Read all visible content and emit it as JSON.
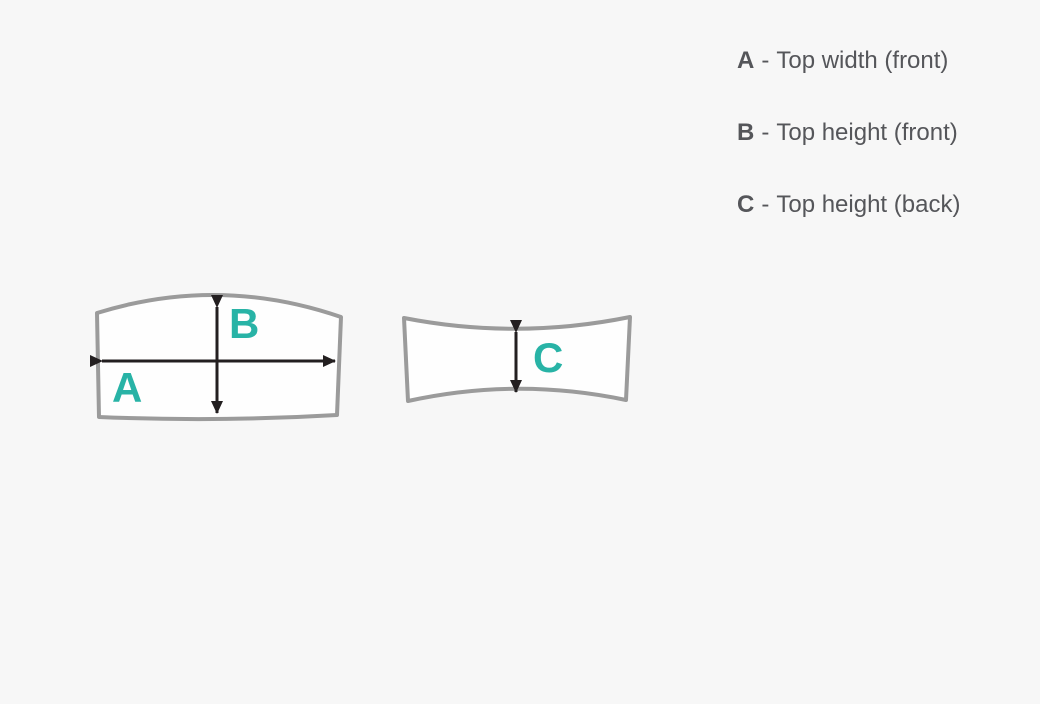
{
  "colors": {
    "background": "#f7f7f7",
    "piece_fill": "#fefefe",
    "piece_outline": "#9b9b9b",
    "arrow_black": "#231f20",
    "accent_teal": "#28b3a6",
    "legend_text": "#55565a"
  },
  "diagram": {
    "front_piece": {
      "width_label": "A",
      "height_label": "B"
    },
    "back_piece": {
      "height_label": "C"
    }
  },
  "legend": {
    "items": [
      {
        "key": "A",
        "separator": "-",
        "description": "Top width (front)"
      },
      {
        "key": "B",
        "separator": "-",
        "description": "Top height (front)"
      },
      {
        "key": "C",
        "separator": "-",
        "description": "Top height (back)"
      }
    ]
  }
}
